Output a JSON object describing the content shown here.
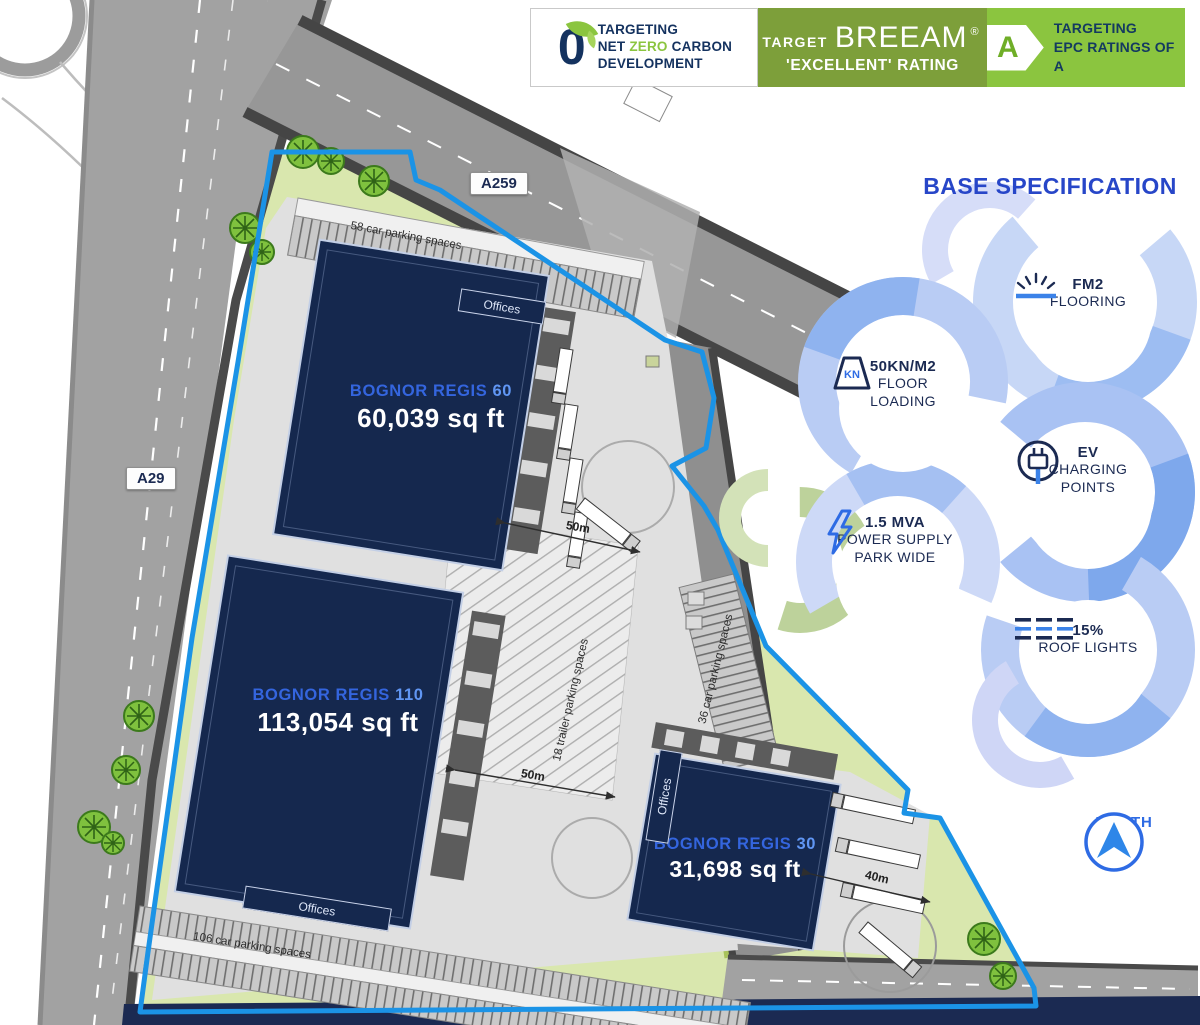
{
  "banner": {
    "net_zero": {
      "logo_glyph": "0",
      "line1": "TARGETING",
      "line2a": "NET",
      "line2b": "ZERO",
      "line2c": "CARBON",
      "line3": "DEVELOPMENT"
    },
    "breeam": {
      "prefix": "TARGET",
      "brand": "BREEAM",
      "reg": "®",
      "line2": "'EXCELLENT' RATING"
    },
    "epc": {
      "letter": "A",
      "line1": "TARGETING",
      "line2": "EPC RATINGS OF A"
    }
  },
  "spec_panel": {
    "title": "BASE SPECIFICATION",
    "items": [
      {
        "id": "fm2",
        "line1": "FM2",
        "line2": "FLOORING"
      },
      {
        "id": "floor-loading",
        "icon_text": "KN",
        "line1": "50KN/M2",
        "line2": "FLOOR",
        "line3": "LOADING"
      },
      {
        "id": "ev-charging",
        "line1": "EV",
        "line2": "CHARGING",
        "line3": "POINTS"
      },
      {
        "id": "power-supply",
        "line1": "1.5 MVA",
        "line2": "POWER SUPPLY",
        "line3": "PARK WIDE"
      },
      {
        "id": "roof-lights",
        "line1": "15%",
        "line2": "ROOF LIGHTS"
      }
    ],
    "north_label": "NORTH"
  },
  "site_plan": {
    "buildings": [
      {
        "name_pre": "BOGNOR REGIS",
        "number": "60",
        "area": "60,039 sq ft"
      },
      {
        "name_pre": "BOGNOR REGIS",
        "number": "110",
        "area": "113,054 sq ft"
      },
      {
        "name_pre": "BOGNOR REGIS",
        "number": "30",
        "area": "31,698 sq ft"
      }
    ],
    "roads": [
      {
        "label": "A259"
      },
      {
        "label": "A29"
      }
    ],
    "parking_labels": [
      "58 car parking spaces",
      "106 car parking spaces",
      "36 car parking spaces",
      "18 trailer parking spaces"
    ],
    "offices_label": "Offices",
    "dimensions": [
      "50m",
      "50m",
      "40m"
    ]
  },
  "colors": {
    "heading_blue": "#2746c8",
    "accent_blue": "#2e6be4",
    "navy": "#15284e",
    "boundary_blue": "#1b93e6",
    "epc_green": "#8bc53f",
    "breeam_olive": "#7d9f3a",
    "site_green": "#d9e7ae",
    "road_grey": "#9f9f9f",
    "yard_grey": "#e0e0e0",
    "label_blue": "#3465de"
  }
}
